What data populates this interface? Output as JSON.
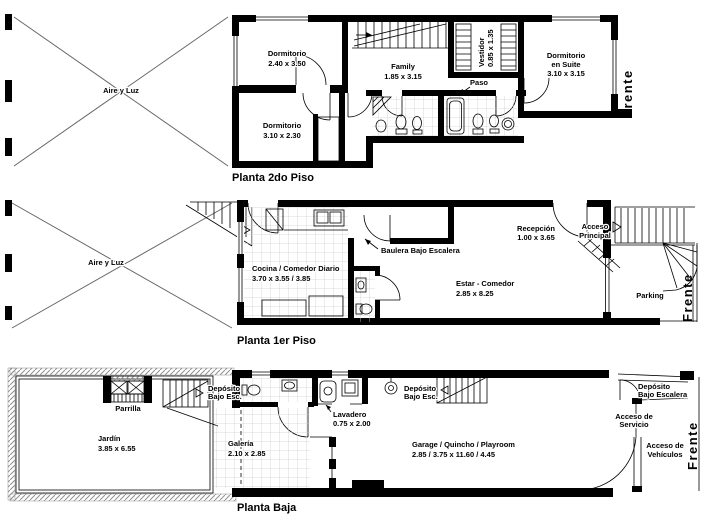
{
  "document": {
    "type": "architectural-floor-plans"
  },
  "colors": {
    "ink": "#000000",
    "hatch": "#909090",
    "tile": "#cfcfcf"
  },
  "plans": {
    "second": {
      "title": "Planta 2do Piso",
      "frente": "Frente",
      "aire": "Aire y Luz",
      "dorm1": {
        "name": "Dormitorio",
        "dims": "2.40 x 3.50"
      },
      "family": {
        "name": "Family",
        "dims": "1.85 x 3.15"
      },
      "vestidor": {
        "name": "Vestidor",
        "dims": "0.85 x 1.35"
      },
      "suite": {
        "name": "Dormitorio",
        "name2": "en Suite",
        "dims": "3.10 x 3.15"
      },
      "paso": {
        "name": "Paso"
      },
      "dorm2": {
        "name": "Dormitorio",
        "dims": "3.10 x 2.30"
      }
    },
    "first": {
      "title": "Planta 1er Piso",
      "frente": "Frente",
      "aire": "Aire y Luz",
      "cocina": {
        "name": "Cocina / Comedor Diario",
        "dims": "3.70 x 3.55 / 3.85"
      },
      "baulera": {
        "name": "Baulera Bajo Escalera"
      },
      "estar": {
        "name": "Estar - Comedor",
        "dims": "2.85 x 8.25"
      },
      "recepcion": {
        "name": "Recepción",
        "dims": "1.00 x 3.65"
      },
      "acceso_principal": {
        "name": "Acceso",
        "name2": "Principal"
      },
      "parking": {
        "name": "Parking"
      }
    },
    "ground": {
      "title": "Planta Baja",
      "frente": "Frente",
      "parrilla": {
        "name": "Parrilla"
      },
      "jardin": {
        "name": "Jardín",
        "dims": "3.85 x 6.55"
      },
      "deposito1": {
        "name": "Depósito",
        "name2": "Bajo Esc."
      },
      "galeria": {
        "name": "Galería",
        "dims": "2.10 x 2.85"
      },
      "lavadero": {
        "name": "Lavadero",
        "dims": "0.75 x 2.00"
      },
      "deposito2": {
        "name": "Depósito",
        "name2": "Bajo Esc."
      },
      "garage": {
        "name": "Garage / Quincho / Playroom",
        "dims": "2.85 / 3.75 x 11.60 / 4.45"
      },
      "deposito3": {
        "name": "Depósito",
        "name2": "Bajo Escalera"
      },
      "acceso_servicio": {
        "name": "Acceso de",
        "name2": "Servicio"
      },
      "acceso_vehiculos": {
        "name": "Acceso de",
        "name2": "Vehículos"
      }
    }
  }
}
